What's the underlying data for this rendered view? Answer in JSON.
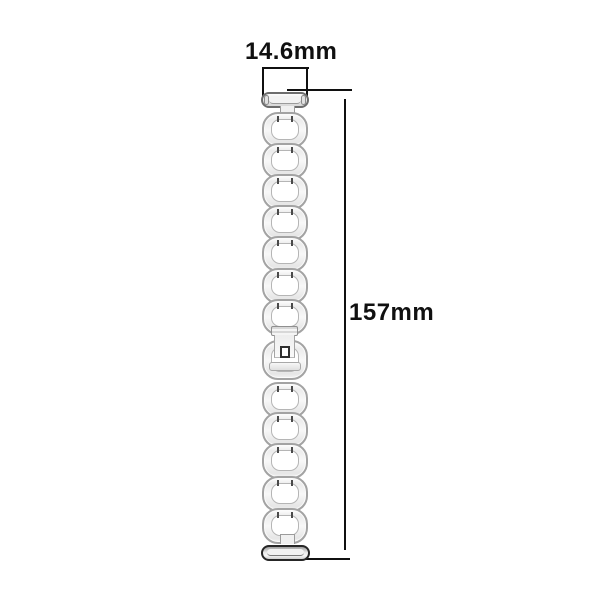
{
  "canvas": {
    "width": 600,
    "height": 600,
    "background": "#ffffff"
  },
  "annotations": {
    "width_label": "14.6mm",
    "length_label": "157mm"
  },
  "dimensions": {
    "width_mm": 14.6,
    "length_mm": 157
  },
  "colors": {
    "dimension_line": "#101010",
    "label_text": "#101010",
    "band_outline": "#a3a3a3",
    "band_fill": "#f0f0f0",
    "bottom_connector_rim": "#262626"
  },
  "band": {
    "item": "metal-link-watch-band",
    "link_count": 13,
    "link_left": 262,
    "link_width": 46,
    "link_height": 36,
    "links": [
      {
        "top": 112
      },
      {
        "top": 143
      },
      {
        "top": 174
      },
      {
        "top": 205
      },
      {
        "top": 236
      },
      {
        "top": 268
      },
      {
        "top": 299
      },
      {
        "top": 340,
        "height": 40,
        "variant": "receiver"
      },
      {
        "top": 382
      },
      {
        "top": 412
      },
      {
        "top": 443
      },
      {
        "top": 476
      },
      {
        "top": 508
      }
    ],
    "clasp": {
      "ribbed_bar": true,
      "push_button": true
    }
  }
}
